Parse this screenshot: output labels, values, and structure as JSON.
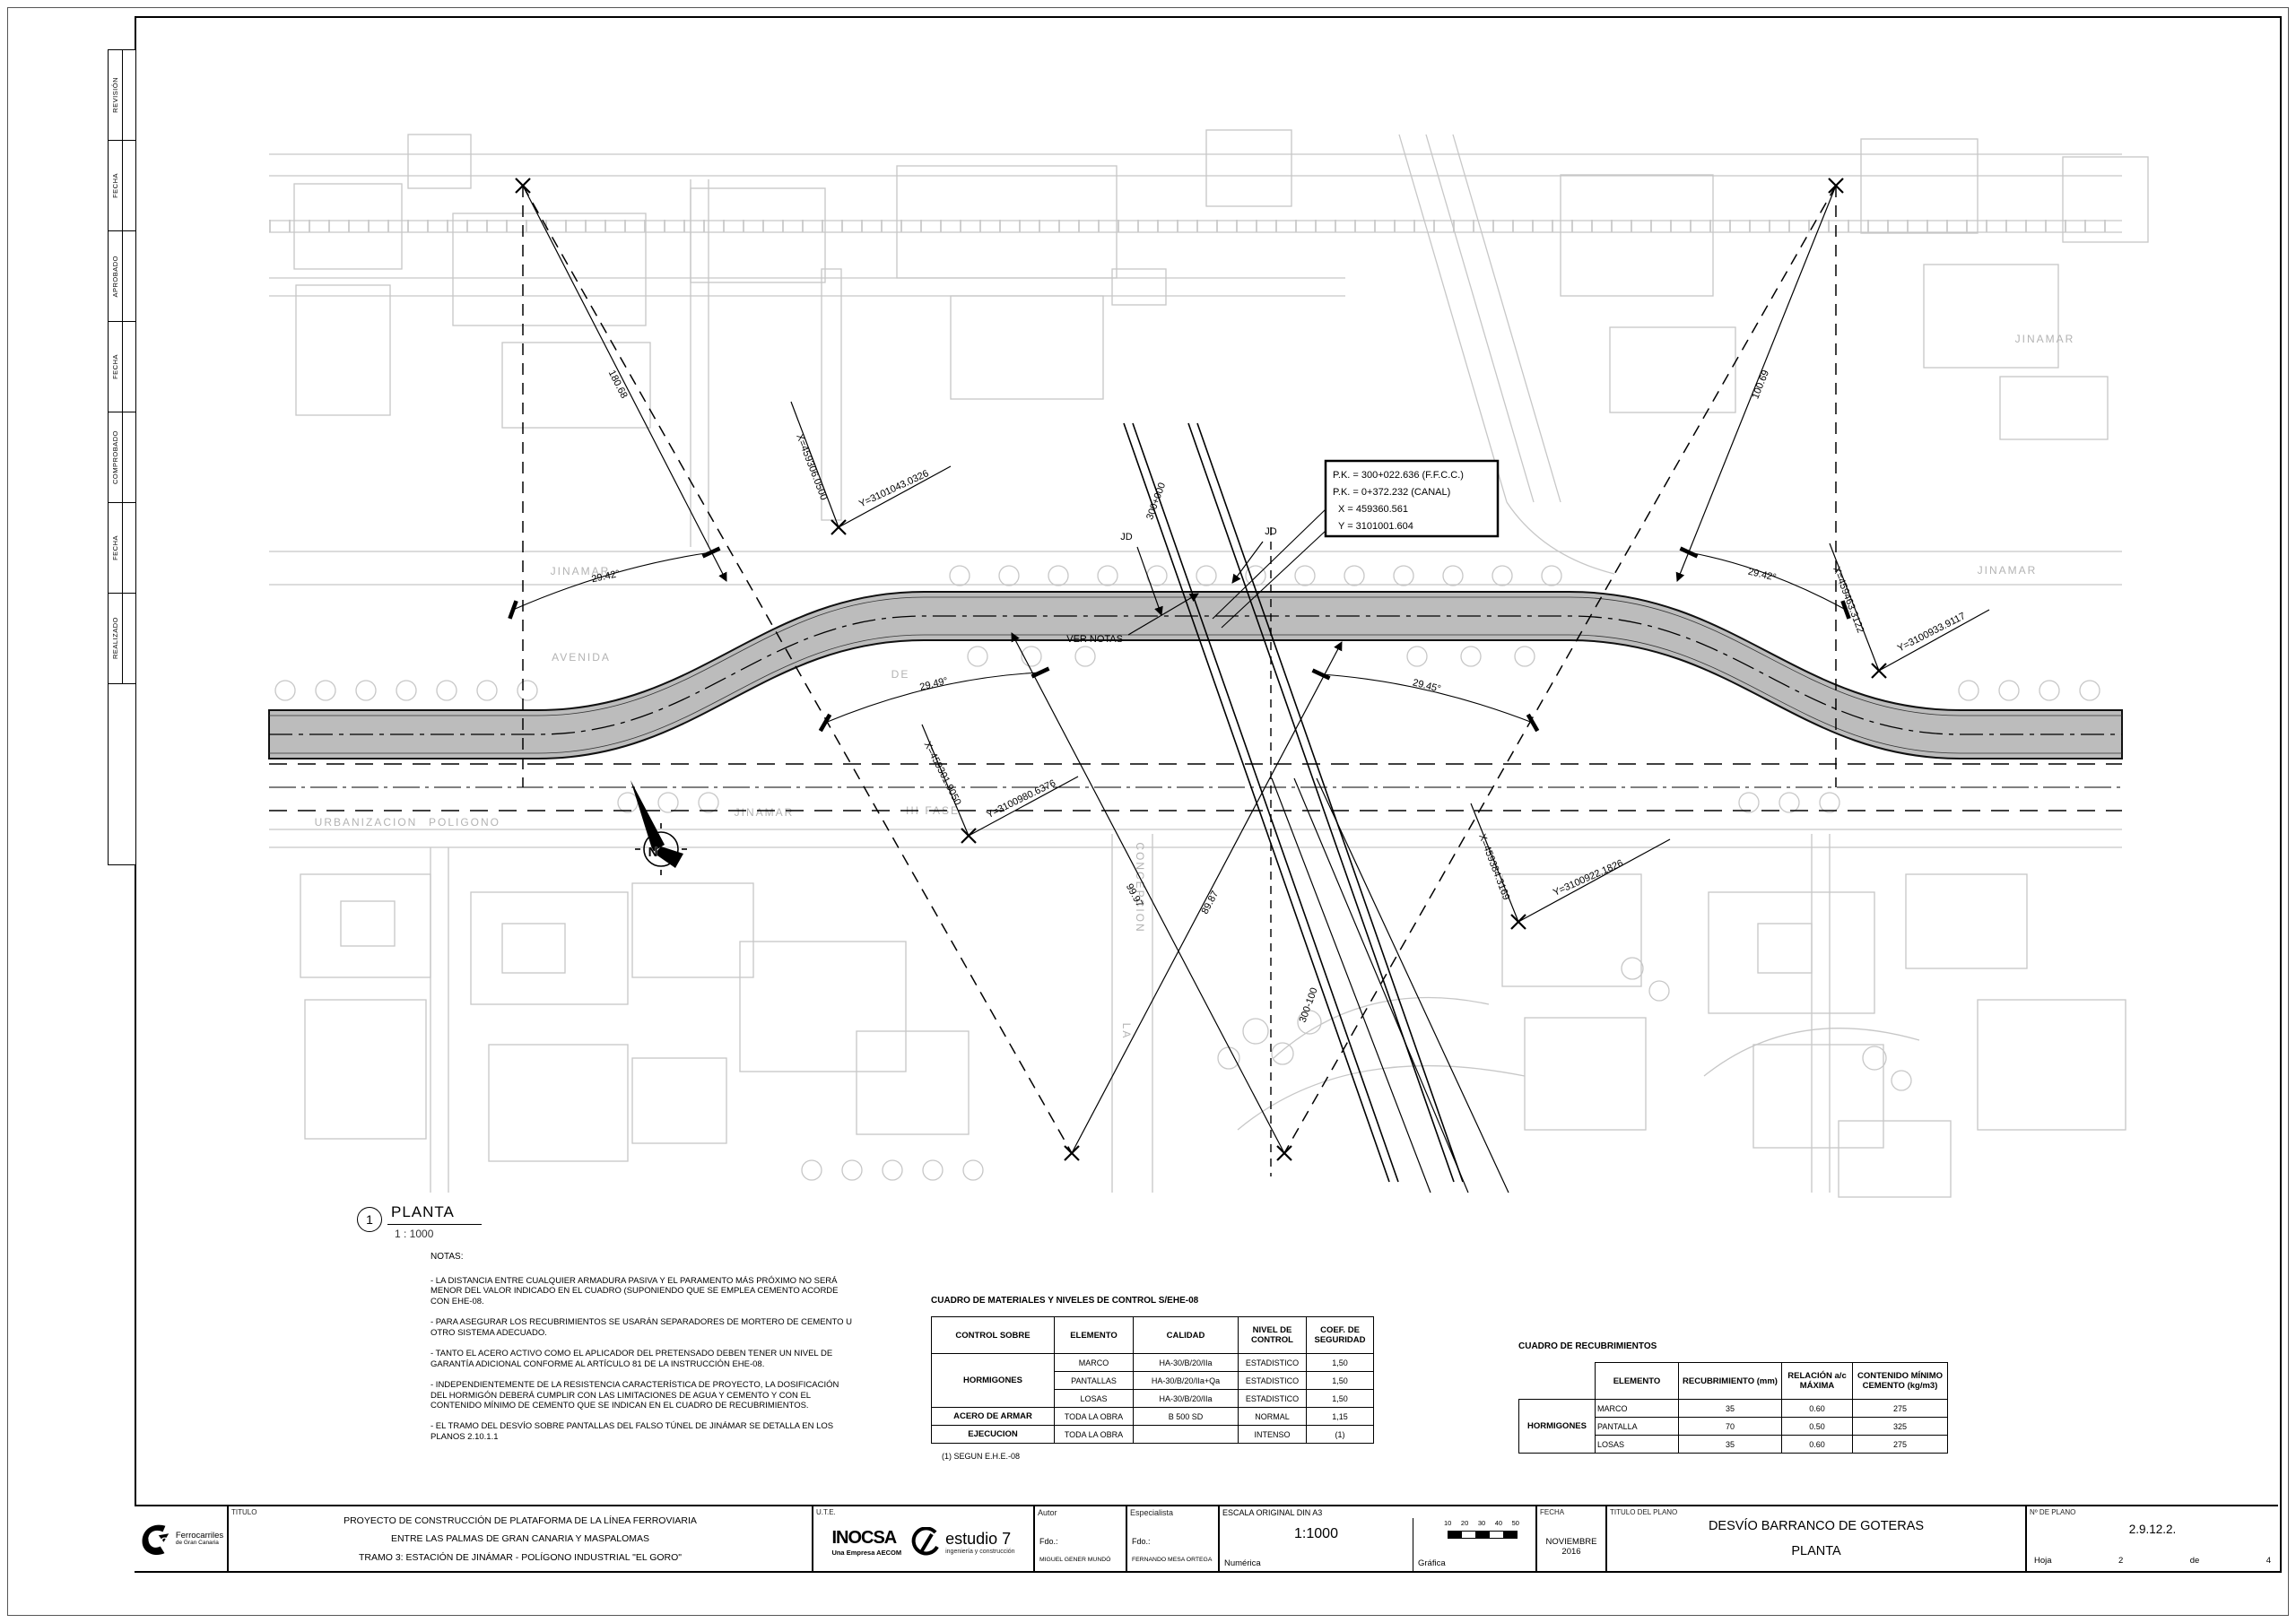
{
  "sheet": {
    "revision_labels": [
      "REVISIÓN",
      "FECHA",
      "APROBADO",
      "FECHA",
      "COMPROBADO",
      "FECHA",
      "REALIZADO"
    ]
  },
  "plan_label": {
    "number": "1",
    "title": "PLANTA",
    "scale": "1 : 1000"
  },
  "drawing": {
    "pk_box": {
      "line1": "P.K. = 300+022.636 (F.F.C.C.)",
      "line2": "P.K. = 0+372.232 (CANAL)",
      "line3": "X = 459360.561",
      "line4": "Y = 3101001.604"
    },
    "labels": {
      "ver_notas": "VER NOTAS",
      "jd1": "JD",
      "jd2": "JD"
    },
    "chainage": {
      "top": "300+000",
      "bottom": "300-100"
    },
    "coords": [
      {
        "x": "X=459306.0500",
        "y": "Y=3101043.0326"
      },
      {
        "x": "X=459463.3122",
        "y": "Y=3100933.9117"
      },
      {
        "x": "X=459301.9050",
        "y": "Y=3100980.6376"
      },
      {
        "x": "X=459384.3169",
        "y": "Y=3100922.1826"
      }
    ],
    "angles": [
      "29.42°",
      "29.42°",
      "29.49°",
      "29.45°"
    ],
    "distances": [
      "180.68",
      "100.69",
      "99.97",
      "89.87"
    ],
    "streets": [
      "JINAMAR",
      "AVENIDA",
      "DE",
      "JINAMAR",
      "URBANIZACION",
      "POLIGONO",
      "III FASE",
      "CONCEPCION",
      "LA",
      "JINAMAR",
      "JINAMAR"
    ],
    "north": "N"
  },
  "notes": {
    "title": "NOTAS:",
    "items": [
      "- LA DISTANCIA ENTRE CUALQUIER ARMADURA PASIVA Y EL PARAMENTO MÁS PRÓXIMO NO SERÁ MENOR DEL VALOR INDICADO EN EL CUADRO (SUPONIENDO QUE SE EMPLEA CEMENTO ACORDE CON EHE-08.",
      "- PARA ASEGURAR LOS RECUBRIMIENTOS SE USARÁN SEPARADORES DE MORTERO DE CEMENTO U OTRO SISTEMA ADECUADO.",
      "- TANTO EL ACERO ACTIVO COMO EL APLICADOR DEL PRETENSADO DEBEN TENER UN NIVEL DE GARANTÍA ADICIONAL CONFORME AL ARTÍCULO 81 DE LA INSTRUCCIÓN EHE-08.",
      "- INDEPENDIENTEMENTE DE LA RESISTENCIA CARACTERÍSTICA DE PROYECTO, LA DOSIFICACIÓN DEL HORMIGÓN DEBERÁ CUMPLIR CON LAS LIMITACIONES DE AGUA Y CEMENTO Y CON EL CONTENIDO MÍNIMO DE CEMENTO QUE SE INDICAN EN EL CUADRO DE RECUBRIMIENTOS.",
      "- EL TRAMO DEL DESVÍO SOBRE PANTALLAS DEL FALSO TÚNEL DE JINÁMAR SE DETALLA EN LOS PLANOS 2.10.1.1"
    ]
  },
  "materials_table": {
    "title": "CUADRO DE MATERIALES Y NIVELES DE CONTROL S/EHE-08",
    "headers": [
      "CONTROL SOBRE",
      "ELEMENTO",
      "CALIDAD",
      "NIVEL DE CONTROL",
      "COEF. DE SEGURIDAD"
    ],
    "group_hormigones": "HORMIGONES",
    "rows_hormigones": [
      [
        "MARCO",
        "HA-30/B/20/IIa",
        "ESTADISTICO",
        "1,50"
      ],
      [
        "PANTALLAS",
        "HA-30/B/20/IIa+Qa",
        "ESTADISTICO",
        "1,50"
      ],
      [
        "LOSAS",
        "HA-30/B/20/IIa",
        "ESTADISTICO",
        "1,50"
      ]
    ],
    "row_acero": [
      "ACERO DE ARMAR",
      "TODA LA OBRA",
      "B 500 SD",
      "NORMAL",
      "1,15"
    ],
    "row_ejecucion": [
      "EJECUCION",
      "TODA LA OBRA",
      "",
      "INTENSO",
      "(1)"
    ],
    "footnote": "(1) SEGUN E.H.E.-08"
  },
  "recubrimientos_table": {
    "title": "CUADRO DE RECUBRIMIENTOS",
    "headers": [
      "ELEMENTO",
      "RECUBRIMIENTO (mm)",
      "RELACIÓN a/c MÁXIMA",
      "CONTENIDO MÍNIMO CEMENTO (kg/m3)"
    ],
    "group": "HORMIGONES",
    "rows": [
      [
        "MARCO",
        "35",
        "0.60",
        "275"
      ],
      [
        "PANTALLA",
        "70",
        "0.50",
        "325"
      ],
      [
        "LOSAS",
        "35",
        "0.60",
        "275"
      ]
    ]
  },
  "title_block": {
    "titulo_label": "TITULO",
    "project_lines": [
      "PROYECTO DE CONSTRUCCIÓN DE PLATAFORMA DE LA LÍNEA FERROVIARIA",
      "ENTRE LAS PALMAS DE GRAN CANARIA Y MASPALOMAS",
      "TRAMO 3: ESTACIÓN DE JINÁMAR - POLÍGONO INDUSTRIAL \"EL GORO\""
    ],
    "tgc": {
      "name": "TGC",
      "line1": "Ferrocarriles",
      "line2": "de Gran Canaria"
    },
    "ute_label": "U.T.E.",
    "inocsa": {
      "name": "INOCSA",
      "sub": "Una Empresa AECOM"
    },
    "estudio7": {
      "name": "estudio 7",
      "sub": "ingeniería y construcción"
    },
    "autor": {
      "label": "Autor",
      "fdo": "Fdo.:",
      "name": "MIGUEL GENER MUNDÓ"
    },
    "especialista": {
      "label": "Especialista",
      "fdo": "Fdo.:",
      "name": "FERNANDO MESA ORTEGA"
    },
    "escala": {
      "label": "ESCALA ORIGINAL DIN A3",
      "value": "1:1000",
      "numerica": "Numérica",
      "grafica": "Gráfica",
      "ticks": [
        "10",
        "20",
        "30",
        "40",
        "50"
      ]
    },
    "fecha": {
      "label": "FECHA",
      "value": "NOVIEMBRE 2016"
    },
    "titulo_plano": {
      "label": "TITULO DEL PLANO",
      "line1": "DESVÍO BARRANCO DE GOTERAS",
      "line2": "PLANTA"
    },
    "num_plano": {
      "label": "Nº DE PLANO",
      "value": "2.9.12.2.",
      "hoja_label": "Hoja",
      "hoja_num": "2",
      "de_label": "de",
      "total": "4"
    }
  }
}
